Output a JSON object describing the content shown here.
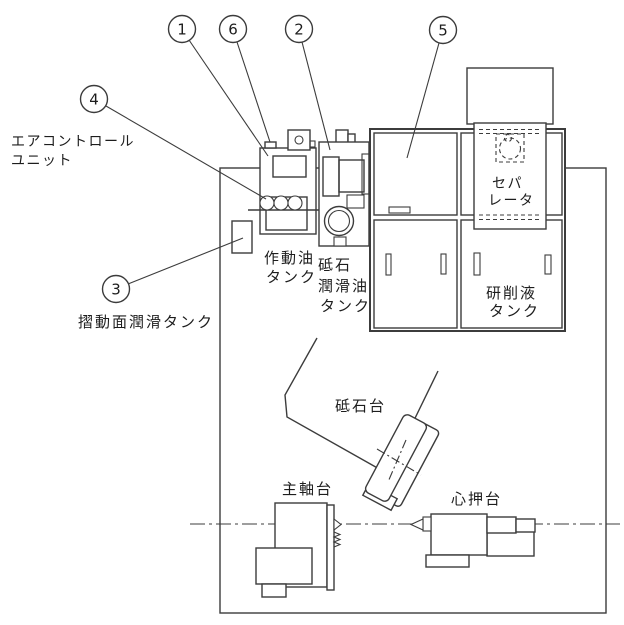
{
  "diagram": {
    "title_hint": "grinding-machine-layout-diagram",
    "callouts": [
      {
        "number": "1"
      },
      {
        "number": "2"
      },
      {
        "number": "3"
      },
      {
        "number": "4"
      },
      {
        "number": "5"
      },
      {
        "number": "6"
      }
    ],
    "labels": {
      "air_control_unit_line1": "エアコントロール",
      "air_control_unit_line2": "ユニット",
      "slide_lubrication_tank": "摺動面潤滑タンク",
      "hydraulic_tank_line1": "作動油",
      "hydraulic_tank_line2": "タンク",
      "wheel_lube_tank_line1": "砥石",
      "wheel_lube_tank_line2": "潤滑油",
      "wheel_lube_tank_line3": "タンク",
      "separator_line1": "セパ",
      "separator_line2": "レータ",
      "coolant_tank_line1": "研削液",
      "coolant_tank_line2": "タンク",
      "wheel_head": "砥石台",
      "headstock": "主軸台",
      "tailstock": "心押台"
    },
    "colors": {
      "line": "#3c3c3c",
      "text": "#1d1d1d",
      "background": "#ffffff"
    }
  }
}
